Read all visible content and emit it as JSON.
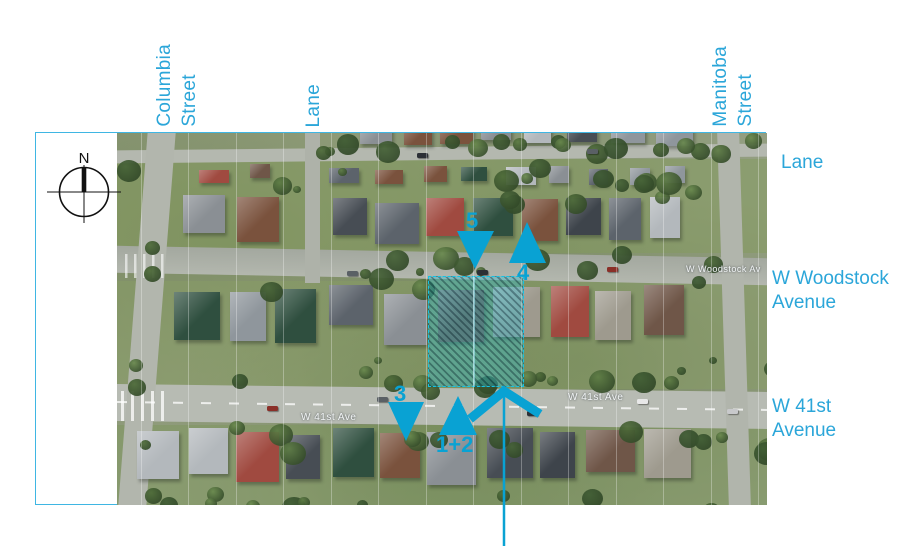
{
  "sheet": {
    "title": "Site Aerial",
    "compass_north": "N"
  },
  "top_labels": [
    {
      "label": "Columbia\nStreet"
    },
    {
      "label": "Lane"
    },
    {
      "label": "Manitoba\nStreet"
    }
  ],
  "right_labels": [
    {
      "label": "Lane"
    },
    {
      "label": "W Woodstock\nAvenue"
    },
    {
      "label": "W 41st\nAvenue"
    }
  ],
  "markers": [
    {
      "label": "5",
      "direction": "down"
    },
    {
      "label": "4",
      "direction": "up"
    },
    {
      "label": "3",
      "direction": "down"
    },
    {
      "label": "1+2",
      "direction": "up"
    }
  ],
  "photo_road_labels": [
    {
      "label": "W Woodstock Av"
    },
    {
      "label": "W 41st Ave"
    },
    {
      "label": "W 41st Ave"
    }
  ],
  "colors": {
    "accent": "#09a2d3",
    "street_label": "#2ba6d9",
    "frame_border": "#3fb6e3",
    "site_hatch": "#14c3e6"
  }
}
